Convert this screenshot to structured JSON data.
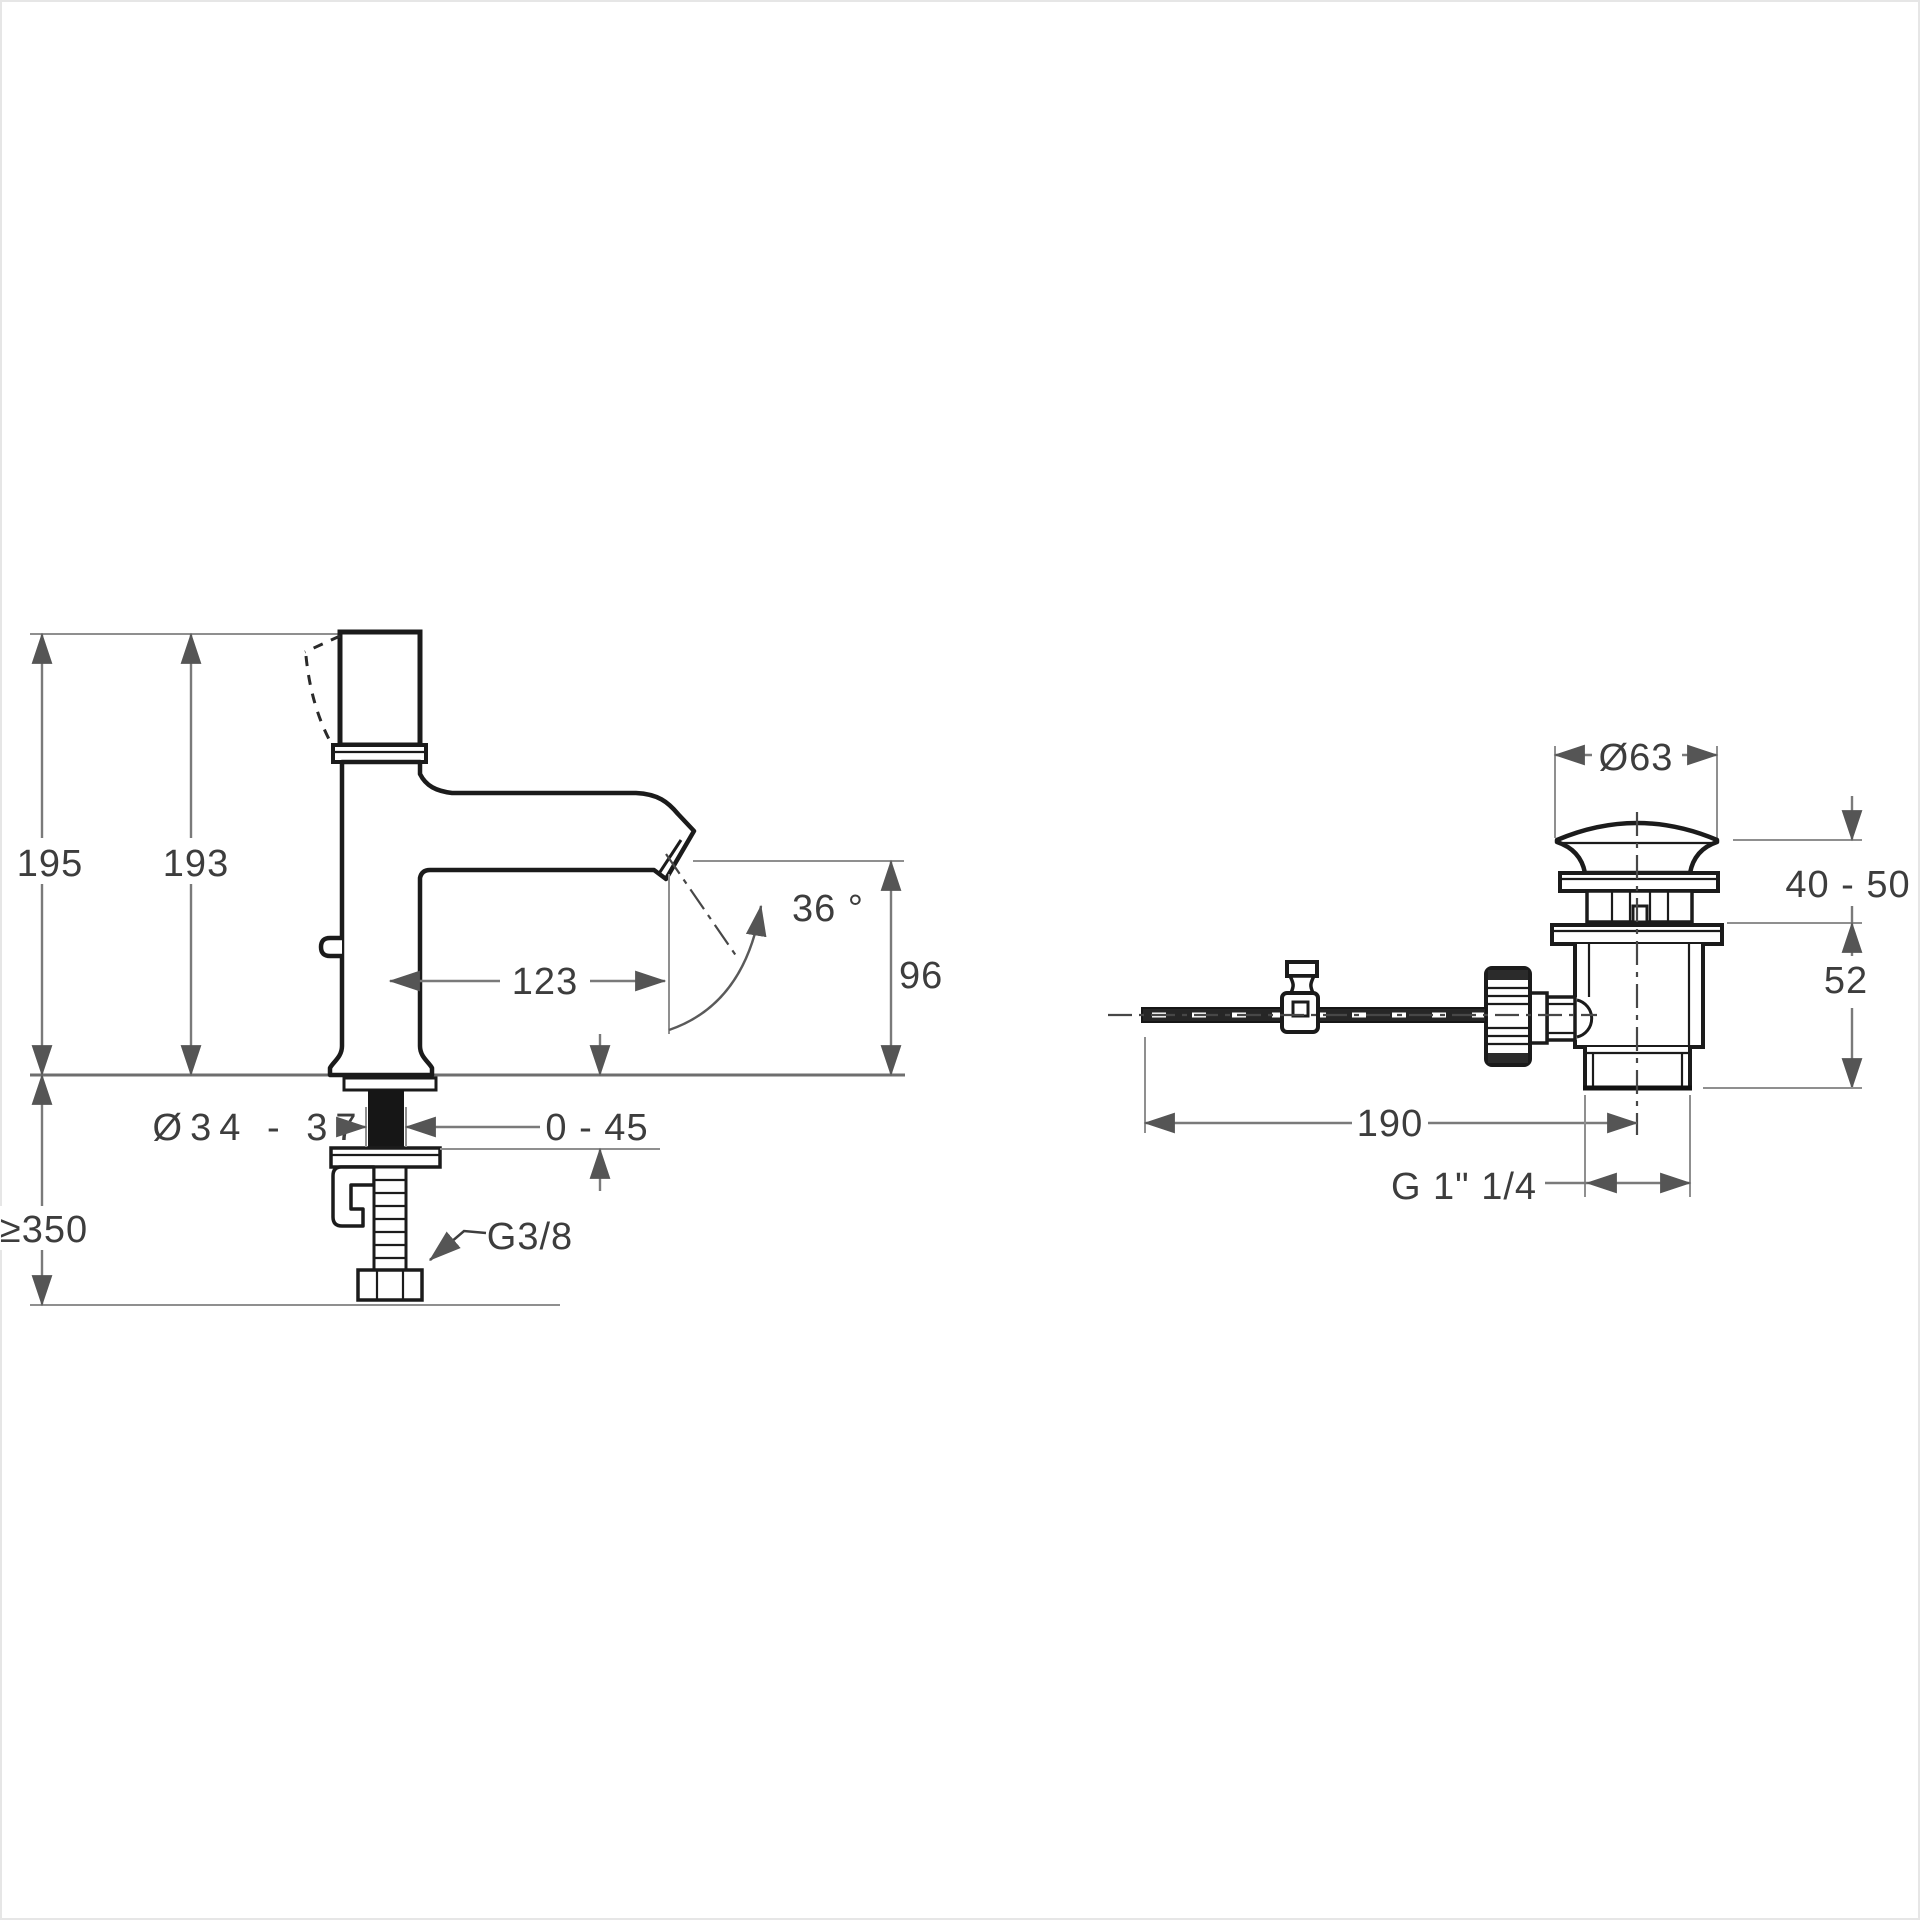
{
  "drawing": {
    "left_view": {
      "height_total": "195",
      "height_to_spout_top": "193",
      "spout_reach": "123",
      "spout_angle": "36 °",
      "spout_height": "96",
      "mounting_hole_diameter": "Ø34 - 37",
      "deck_thickness_range": "0 - 45",
      "clearance_below_deck": "≥350",
      "supply_thread": "G3/8"
    },
    "right_view": {
      "flange_diameter": "Ø63",
      "basin_thickness_range": "40 - 50",
      "body_height": "52",
      "rod_length": "190",
      "waste_thread": "G 1\" 1/4"
    }
  }
}
